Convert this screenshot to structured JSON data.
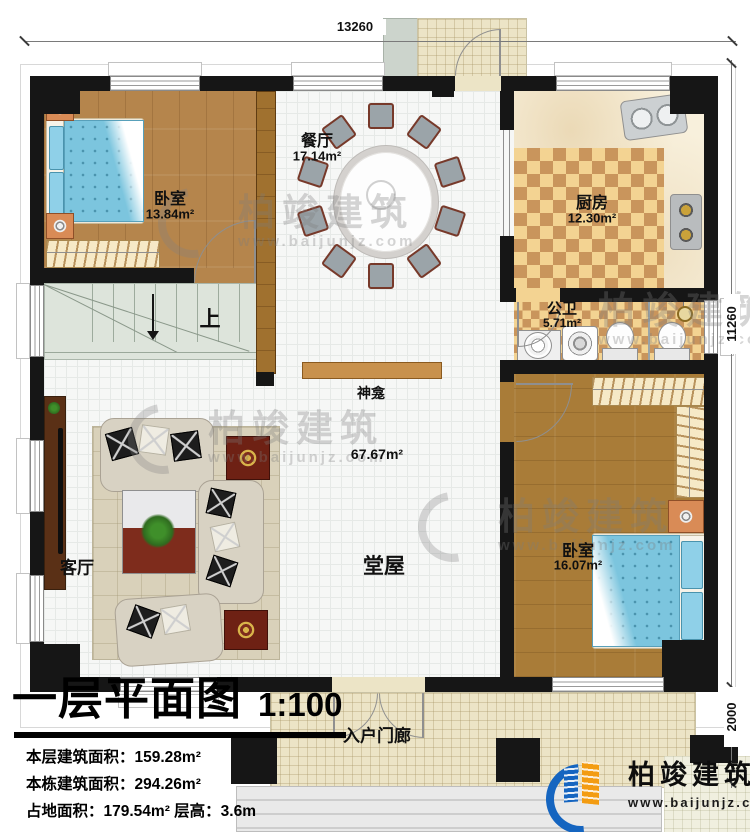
{
  "dimensions": {
    "top": "13260",
    "right": "11260",
    "right_lower": "2000"
  },
  "rooms": {
    "bedroom1": {
      "label": "卧室",
      "area": "13.84m²"
    },
    "dining": {
      "label": "餐厅",
      "area": "17.14m²"
    },
    "kitchen": {
      "label": "厨房",
      "area": "12.30m²"
    },
    "bathroom": {
      "label": "公卫",
      "area": "5.71m²"
    },
    "bedroom2": {
      "label": "卧室",
      "area": "16.07m²"
    },
    "living": {
      "label": "客厅"
    },
    "hall": {
      "label": "堂屋",
      "area": "67.67m²"
    },
    "shrine": {
      "label": "神龛"
    },
    "stairs": {
      "label": "上"
    },
    "entry_porch": {
      "label": "入户门廊"
    }
  },
  "title_block": {
    "title": "一层平面图",
    "scale": "1:100",
    "stats": [
      "本层建筑面积：159.28m²",
      "本栋建筑面积：294.26m²",
      "占地面积：179.54m²  层高：3.6m"
    ]
  },
  "brand": {
    "name": "柏竣建筑",
    "website": "www.baijunjz.com"
  },
  "watermark": {
    "name": "柏竣建筑",
    "website": "www.baijunjz.com"
  },
  "colors": {
    "wall": "#161616",
    "wood": "#b5854c",
    "wood_dark": "#a97c38",
    "checker": "#c9955c",
    "bed_blue": "#7cc5de",
    "shrine_wood": "#c8914d",
    "brand_blue": "#1565c0",
    "brand_orange": "#f39c12"
  }
}
